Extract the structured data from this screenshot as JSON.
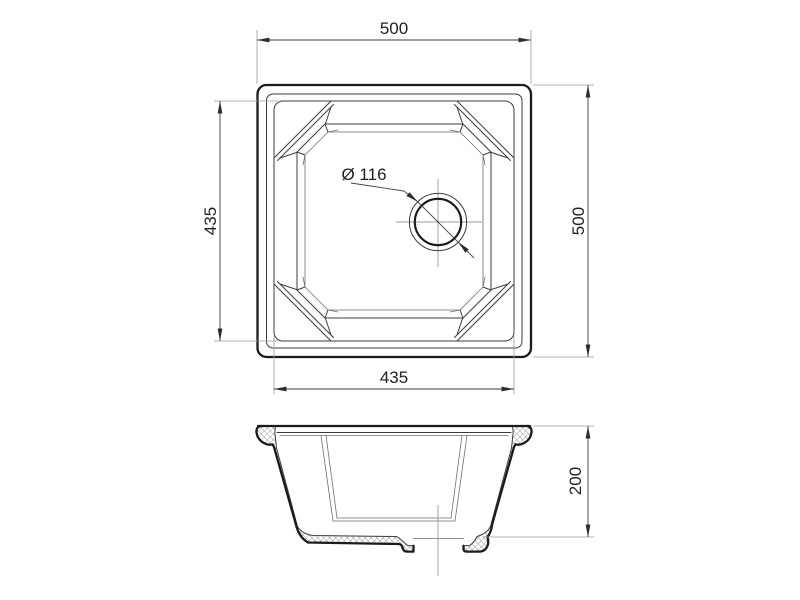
{
  "drawing": {
    "kind": "sink technical drawing, two views",
    "colors": {
      "outline": "#1b1b1b",
      "detail_line": "#3c3c3c",
      "dimension_line": "#3d3d3d",
      "extension_line": "#9b9b9b",
      "centerline": "#999999",
      "background": "#ffffff"
    }
  },
  "dimensions": {
    "overall_width_top": "500",
    "bowl_height_left": "435",
    "overall_height_right": "500",
    "bowl_width_bottom": "435",
    "drain_diameter": "Ø 116",
    "section_height": "200"
  }
}
